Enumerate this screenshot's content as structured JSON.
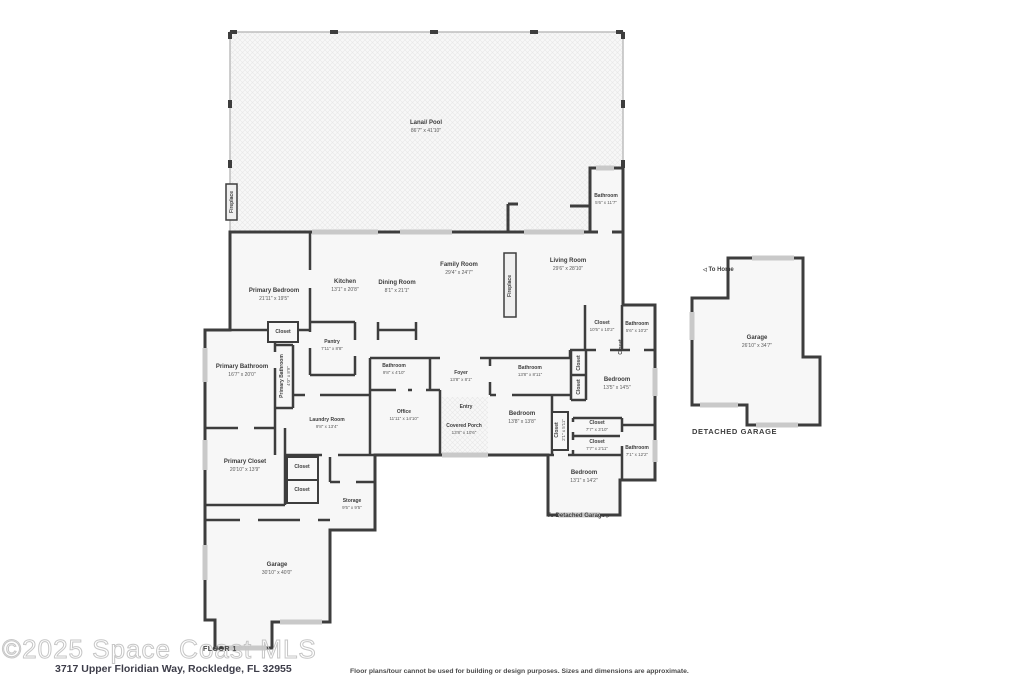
{
  "footer": {
    "watermark": "©2025 Space Coast MLS",
    "floor_label": "FLOOR 1",
    "address": "3717 Upper Floridian Way, Rockledge, FL 32955",
    "disclaimer": "Floor plans/tour cannot be used for building or design purposes. Sizes and dimensions are approximate."
  },
  "annotations": {
    "to_home": "To Home",
    "to_detached_garage": "To Detached Garage",
    "detached_garage_caption": "DETACHED GARAGE"
  },
  "colors": {
    "wall": "#3d3d3d",
    "room_fill": "#f7f7f7",
    "window": "#c9c9c9",
    "hatch_line": "#e8e8e8",
    "watermark": "#c6c6c6"
  },
  "floorplan": {
    "rooms": [
      {
        "label": "Lanai/ Pool",
        "dims": "86'7\" x 41'10\"",
        "x": 426,
        "y": 127
      },
      {
        "label": "Fireplace",
        "x": 232,
        "y": 202,
        "rot": -90,
        "small": true
      },
      {
        "label": "Bathroom",
        "dims": "5'6\" x 11'7\"",
        "x": 606,
        "y": 199,
        "small": true
      },
      {
        "label": "Primary Bedroom",
        "dims": "21'11\" x 19'5\"",
        "x": 274,
        "y": 295
      },
      {
        "label": "Kitchen",
        "dims": "13'1\" x 20'8\"",
        "x": 345,
        "y": 286
      },
      {
        "label": "Dining Room",
        "dims": "8'1\" x 21'1\"",
        "x": 397,
        "y": 287
      },
      {
        "label": "Family Room",
        "dims": "29'4\" x 24'7\"",
        "x": 459,
        "y": 269
      },
      {
        "label": "Fireplace",
        "x": 510,
        "y": 286,
        "rot": -90,
        "small": true
      },
      {
        "label": "Living Room",
        "dims": "29'6\" x 28'10\"",
        "x": 568,
        "y": 265
      },
      {
        "label": "Closet",
        "x": 283,
        "y": 332,
        "small": true
      },
      {
        "label": "Pantry",
        "dims": "7'11\" x 8'8\"",
        "x": 332,
        "y": 345,
        "small": true
      },
      {
        "label": "Primary Bathroom",
        "dims": "16'7\" x 20'0\"",
        "x": 242,
        "y": 371
      },
      {
        "label": "Primary Bathroom",
        "dims": "4'0\" x 8'9\"",
        "x": 285,
        "y": 376,
        "rot": -90,
        "small": true
      },
      {
        "label": "Closet",
        "dims": "10'5\" x 10'2\"",
        "x": 602,
        "y": 326,
        "small": true
      },
      {
        "label": "Bathroom",
        "dims": "5'6\" x 10'2\"",
        "x": 637,
        "y": 327,
        "small": true
      },
      {
        "label": "Closet",
        "x": 621,
        "y": 347,
        "rot": -90,
        "small": true
      },
      {
        "label": "Bathroom",
        "dims": "9'8\" x 4'10\"",
        "x": 394,
        "y": 369,
        "small": true
      },
      {
        "label": "Foyer",
        "dims": "13'8\" x 8'1\"",
        "x": 461,
        "y": 376,
        "small": true
      },
      {
        "label": "Bathroom",
        "dims": "13'8\" x 8'11\"",
        "x": 530,
        "y": 371,
        "small": true
      },
      {
        "label": "Closet",
        "x": 579,
        "y": 363,
        "rot": -90,
        "small": true
      },
      {
        "label": "Closet",
        "x": 579,
        "y": 387,
        "rot": -90,
        "small": true
      },
      {
        "label": "Bedroom",
        "dims": "13'5\" x 14'5\"",
        "x": 617,
        "y": 384
      },
      {
        "label": "Office",
        "dims": "11'11\" x 14'10\"",
        "x": 404,
        "y": 415,
        "small": true
      },
      {
        "label": "Entry",
        "x": 466,
        "y": 407,
        "small": true
      },
      {
        "label": "Covered Porch",
        "dims": "13'8\" x 10'6\"",
        "x": 464,
        "y": 429,
        "small": true
      },
      {
        "label": "Bedroom",
        "dims": "13'8\" x 13'8\"",
        "x": 522,
        "y": 418
      },
      {
        "label": "Closet",
        "dims": "2'1\" x 5'11\"",
        "x": 560,
        "y": 430,
        "rot": -90,
        "small": true
      },
      {
        "label": "Laundry Room",
        "dims": "9'8\" x 13'4\"",
        "x": 327,
        "y": 423,
        "small": true
      },
      {
        "label": "Closet",
        "x": 302,
        "y": 467,
        "small": true
      },
      {
        "label": "Closet",
        "x": 302,
        "y": 490,
        "small": true
      },
      {
        "label": "Primary Closet",
        "dims": "20'10\" x 13'9\"",
        "x": 245,
        "y": 466
      },
      {
        "label": "Storage",
        "dims": "9'5\" x 9'5\"",
        "x": 352,
        "y": 504,
        "small": true
      },
      {
        "label": "Closet",
        "dims": "7'7\" x 3'10\"",
        "x": 597,
        "y": 426,
        "small": true
      },
      {
        "label": "Closet",
        "dims": "7'7\" x 2'11\"",
        "x": 597,
        "y": 445,
        "small": true
      },
      {
        "label": "Bathroom",
        "dims": "7'1\" x 12'2\"",
        "x": 637,
        "y": 451,
        "small": true
      },
      {
        "label": "Bedroom",
        "dims": "13'1\" x 14'2\"",
        "x": 584,
        "y": 477
      },
      {
        "label": "Garage",
        "dims": "30'10\" x 40'0\"",
        "x": 277,
        "y": 569
      },
      {
        "label": "Garage",
        "dims": "26'10\" x 34'7\"",
        "x": 757,
        "y": 342
      }
    ]
  }
}
